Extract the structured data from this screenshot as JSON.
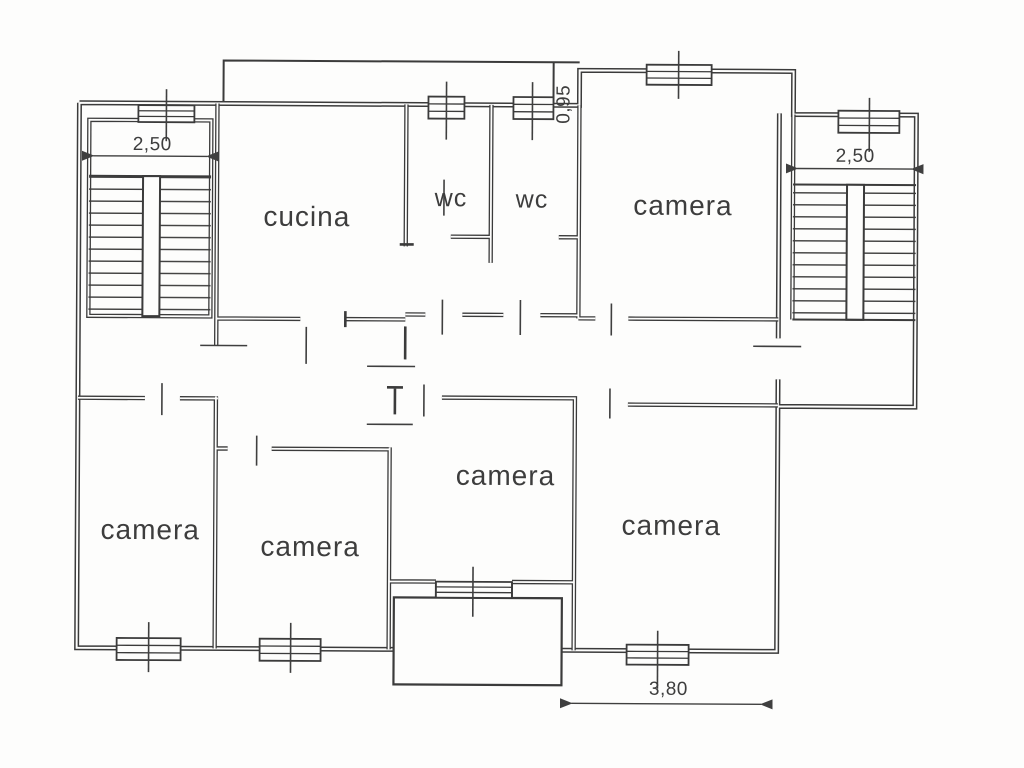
{
  "drawing": {
    "type": "apartment floor plan",
    "ink_color": "#3b3b3b",
    "paper_color": "#fdfdfc"
  },
  "rooms": [
    {
      "name": "kitchen",
      "label": "cucina"
    },
    {
      "name": "wc-left",
      "label": "wc"
    },
    {
      "name": "wc-right",
      "label": "wc"
    },
    {
      "name": "bedroom-top-right",
      "label": "camera"
    },
    {
      "name": "bedroom-bottom-left",
      "label": "camera"
    },
    {
      "name": "bedroom-bottom-midleft",
      "label": "camera"
    },
    {
      "name": "bedroom-bottom-center",
      "label": "camera"
    },
    {
      "name": "bedroom-bottom-right",
      "label": "camera"
    }
  ],
  "dimensions": [
    {
      "name": "left-staircase-width",
      "label": "2,50"
    },
    {
      "name": "right-staircase-width",
      "label": "2,50"
    },
    {
      "name": "top-balcony-depth",
      "label": "0,95"
    },
    {
      "name": "bottom-room-width",
      "label": "3,80"
    }
  ]
}
